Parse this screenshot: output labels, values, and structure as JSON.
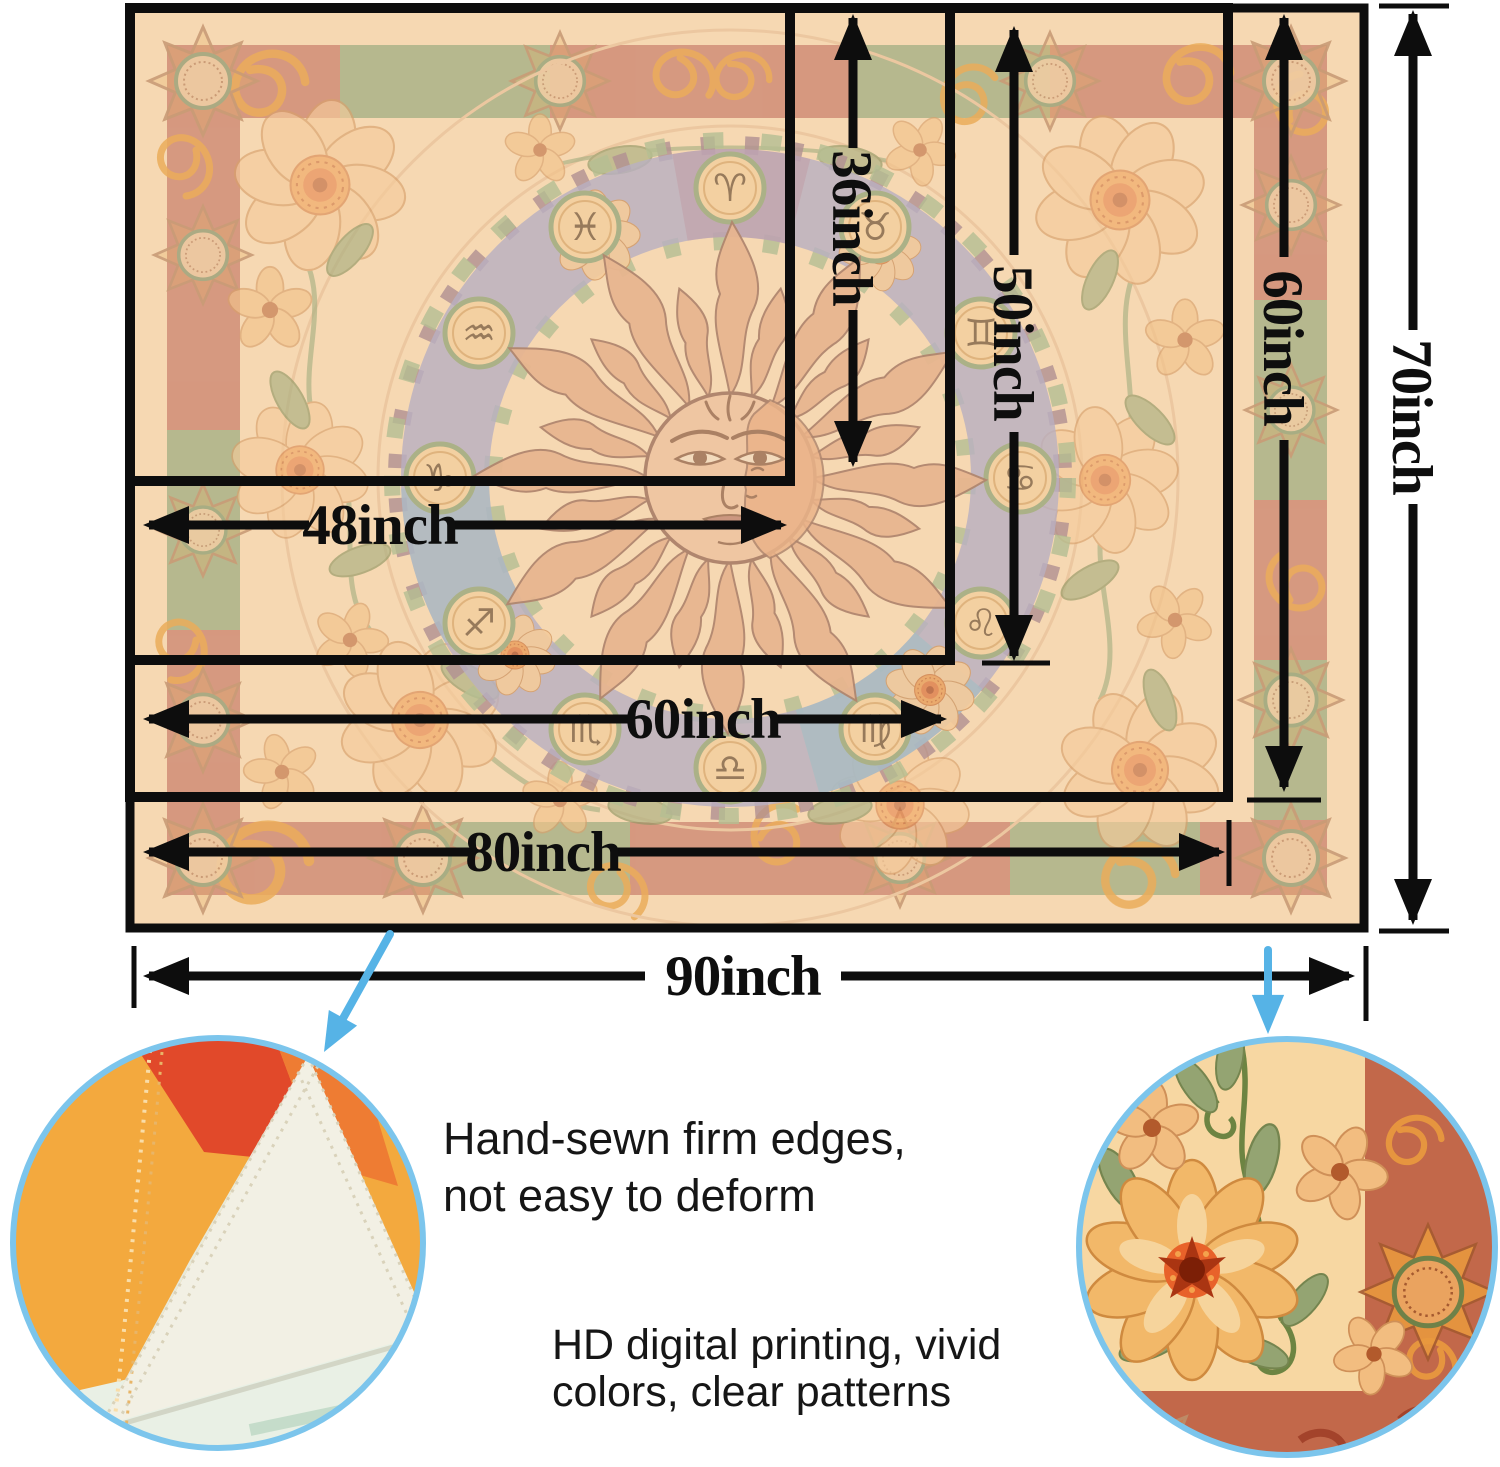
{
  "page": {
    "background": "#ffffff",
    "description": "tapestry size chart infographic"
  },
  "sizes": {
    "s48x36": {
      "width": "48inch",
      "height": "36inch"
    },
    "s60x50": {
      "width": "60inch",
      "height": "50inch"
    },
    "s80x60": {
      "width": "80inch",
      "height": "60inch"
    },
    "s90x70": {
      "width": "90inch",
      "height": "70inch"
    }
  },
  "callouts": {
    "edges": {
      "line1": "Hand-sewn firm edges,",
      "line2": "not easy to deform"
    },
    "printing": {
      "line1": "HD digital printing, vivid",
      "line2": "colors, clear patterns"
    }
  },
  "zodiac_glyphs": [
    "♈",
    "♉",
    "♊",
    "♋",
    "♌",
    "♍",
    "♎",
    "♏",
    "♐",
    "♑",
    "♒",
    "♓"
  ],
  "colors": {
    "dimension_line": "#0d0d0d",
    "callout_blue": "#56b3e6",
    "circle_rim": "#7cc5ec",
    "tapestry_background": "#f6d8b2",
    "border_band_terracotta": "#c97e6b",
    "border_band_green": "#9cab80",
    "zodiac_ring_lavender": "#a8a4c6",
    "sun_body": "#e3ab86",
    "gold_swirl": "#e8a043",
    "caption_text": "#161616"
  }
}
